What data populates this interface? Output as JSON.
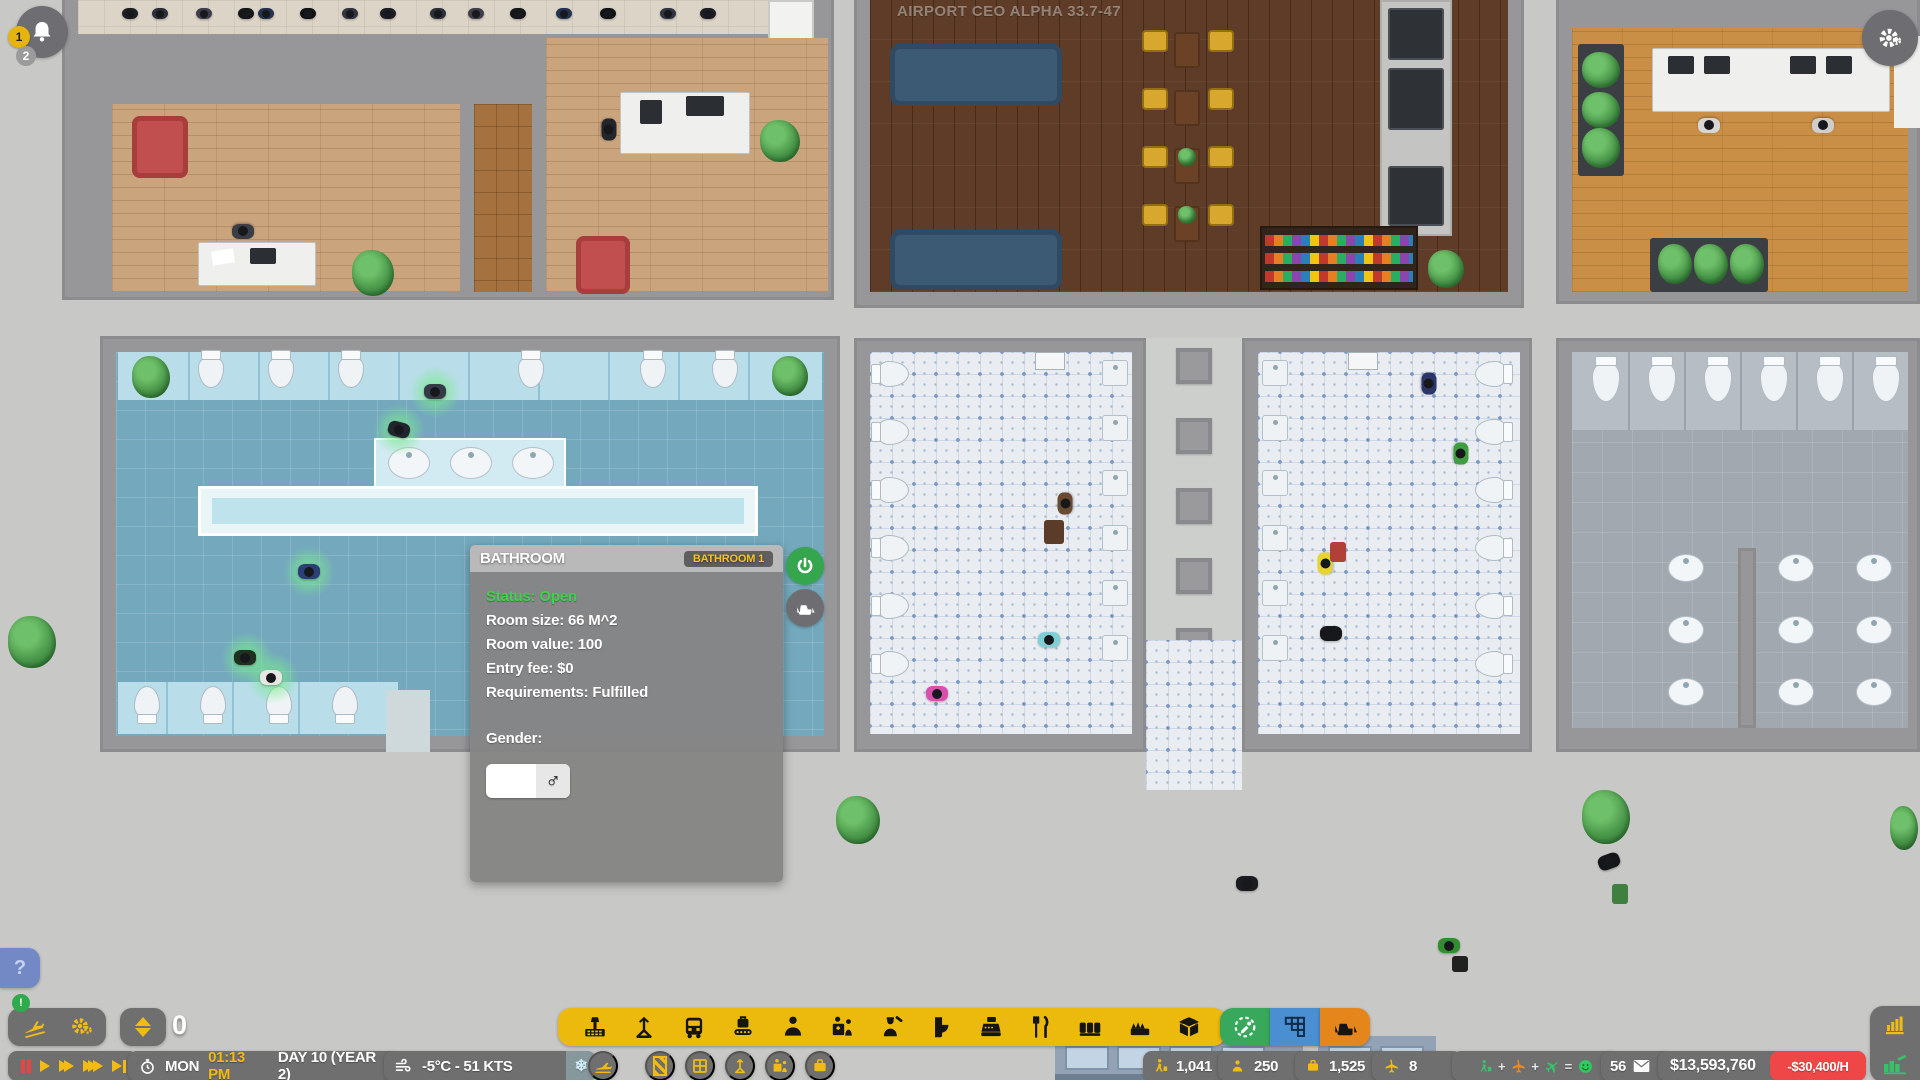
{
  "watermark": "AIRPORT CEO ALPHA 33.7-47",
  "notifications": {
    "badge_top": "1",
    "badge_bottom": "2",
    "alert_badge": "!"
  },
  "help_button": "?",
  "inspect_panel": {
    "title": "BATHROOM",
    "badge": "BATHROOM 1",
    "lines": {
      "status": "Status: Open",
      "room_size": "Room size: 66 M^2",
      "room_value": "Room value: 100",
      "entry_fee": "Entry fee: $0",
      "requirements": "Requirements: Fulfilled"
    },
    "gender_label": "Gender:",
    "gender_value": "♂",
    "side_buttons": [
      "power-toggle",
      "demolish-room"
    ]
  },
  "build_bar": {
    "floor_level": "0",
    "tool_icons": [
      "airport-building",
      "mast",
      "bus-transit",
      "baggage-handling",
      "staff",
      "check-in-desk",
      "security",
      "bathroom",
      "shops",
      "food",
      "seating",
      "plants",
      "delivery-box"
    ],
    "mode_buttons": [
      "zone-picker",
      "floor-tiles",
      "demolish"
    ]
  },
  "status_bar": {
    "speed_controls": [
      "pause",
      "play",
      "fast",
      "faster",
      "skip-to-event"
    ],
    "weekday": "MON",
    "time": "01:13 PM",
    "date": "DAY 10 (YEAR 2)",
    "weather": "-5°C - 51 KTS",
    "passengers": "1,041",
    "staff": "250",
    "bags": "1,525",
    "flights": "8",
    "happiness": {
      "plus1": "+",
      "plus2": "+",
      "equals": "="
    },
    "mail_count": "56",
    "balance": "$13,593,760",
    "hourly_rate": "-$30,400/H"
  },
  "colors": {
    "toolbar_yellow": "#ecba0c",
    "accent_green": "#38a95c",
    "accent_blue": "#4a8fd2",
    "accent_orange": "#e5861d",
    "alert_red": "#ef4747",
    "text_yellow": "#f2bb13",
    "status_green": "#3ed24b",
    "power_green": "#35a54e"
  }
}
